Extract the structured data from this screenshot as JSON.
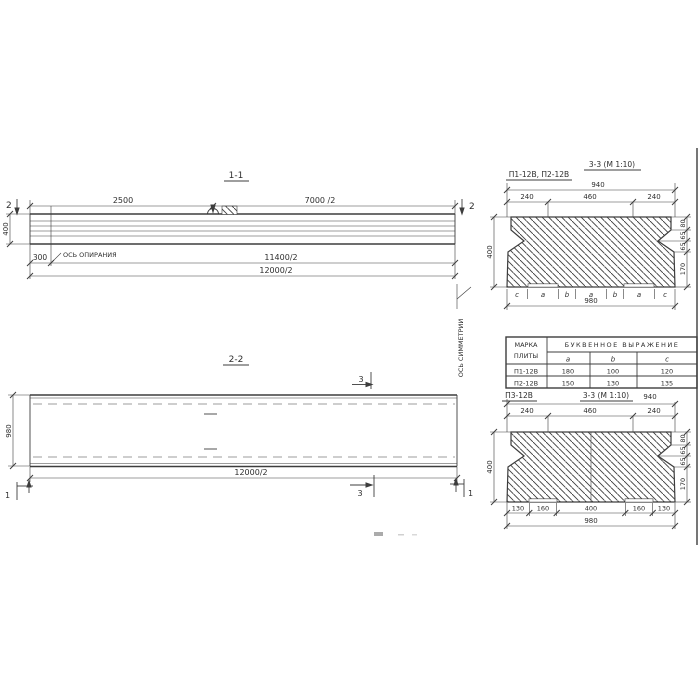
{
  "s11": {
    "title": "1-1",
    "cut_label": "2",
    "dim_top_left": "2500",
    "dim_top_right": "7000 /2",
    "dim_height": "400",
    "dim_offset": "300",
    "support_axis_label": "ОСЬ ОПИРАНИЯ",
    "dim_support_span": "11400/2",
    "dim_total": "12000/2"
  },
  "s22": {
    "title": "2-2",
    "dim_width": "980",
    "dim_length": "12000/2",
    "cut_label_3": "3",
    "cut_label_1": "1",
    "symmetry_axis_label": "ОСЬ СИММЕТРИИ"
  },
  "s33top": {
    "label": "П1-12В, П2-12В",
    "title": "3-3 (М 1:10)",
    "dim_overall_top": "940",
    "top_dims": [
      "240",
      "460",
      "240"
    ],
    "dim_height": "400",
    "right_dims": [
      "80",
      "65",
      "65",
      "170"
    ],
    "bottom_letters": [
      "c",
      "a",
      "b",
      "a",
      "b",
      "a",
      "c"
    ],
    "dim_overall_bottom": "980"
  },
  "table": {
    "header_col1_line1": "МАРКА",
    "header_col1_line2": "ПЛИТЫ",
    "header_group": "БУКВЕННОЕ  ВЫРАЖЕНИЕ",
    "columns": [
      "a",
      "b",
      "c"
    ],
    "rows": [
      {
        "mark": "П1-12В",
        "a": "180",
        "b": "100",
        "c": "120"
      },
      {
        "mark": "П2-12В",
        "a": "150",
        "b": "130",
        "c": "135"
      }
    ]
  },
  "s33bot": {
    "label": "П3-12В",
    "title": "3-3 (М 1:10)",
    "dim_overall_top": "940",
    "top_dims": [
      "240",
      "460",
      "240"
    ],
    "dim_height": "400",
    "right_dims": [
      "80",
      "65",
      "65",
      "170"
    ],
    "bottom_dims": [
      "130",
      "160",
      "400",
      "160",
      "130"
    ],
    "dim_overall_bottom": "980"
  }
}
